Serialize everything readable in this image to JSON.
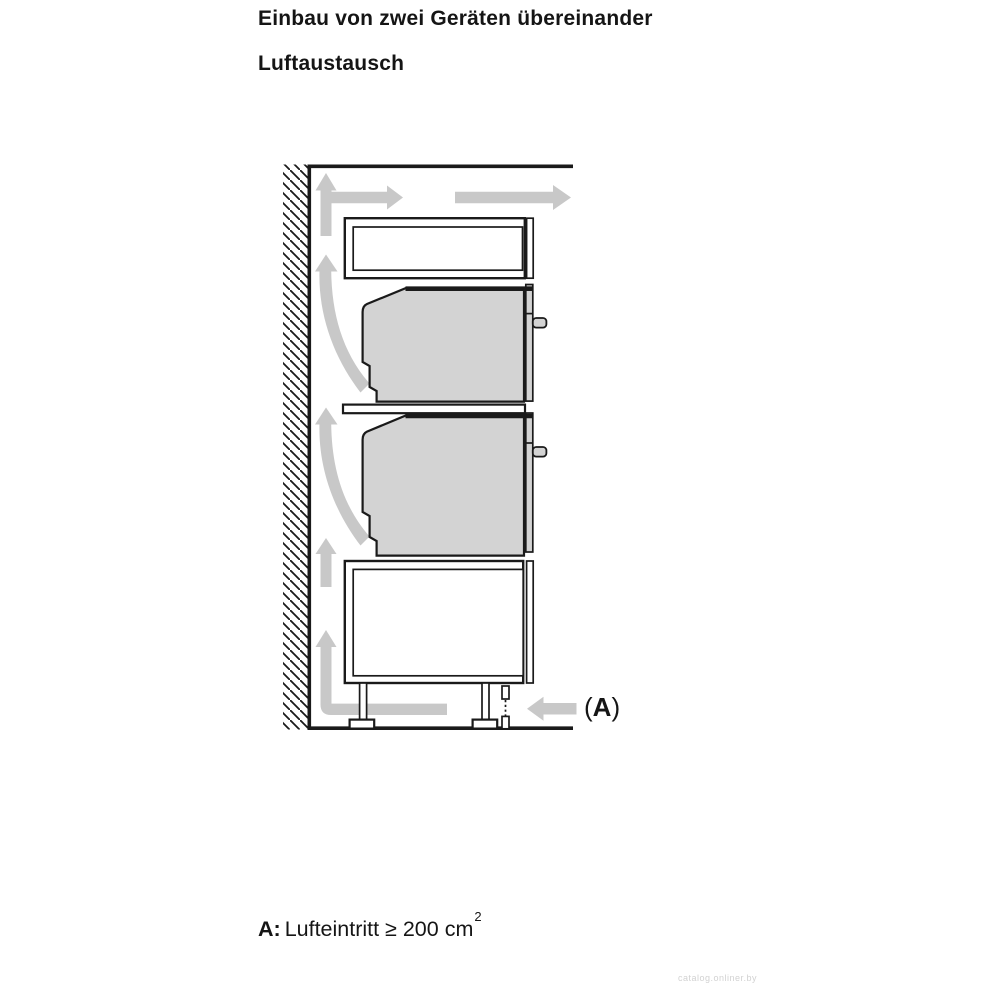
{
  "header": {
    "title": "Einbau von zwei Geräten übereinander",
    "subtitle": "Luftaustausch"
  },
  "diagram": {
    "air_inlet_marker": {
      "open": "(",
      "letter": "A",
      "close": ")"
    },
    "colors": {
      "line": "#1a1a1a",
      "appliance_fill": "#d3d3d3",
      "airflow_fill": "#c8c8c8"
    }
  },
  "legend": {
    "key": "A:",
    "text": "Lufteintritt ≥ 200 cm",
    "superscript": "2"
  },
  "watermark": "catalog.onliner.by"
}
